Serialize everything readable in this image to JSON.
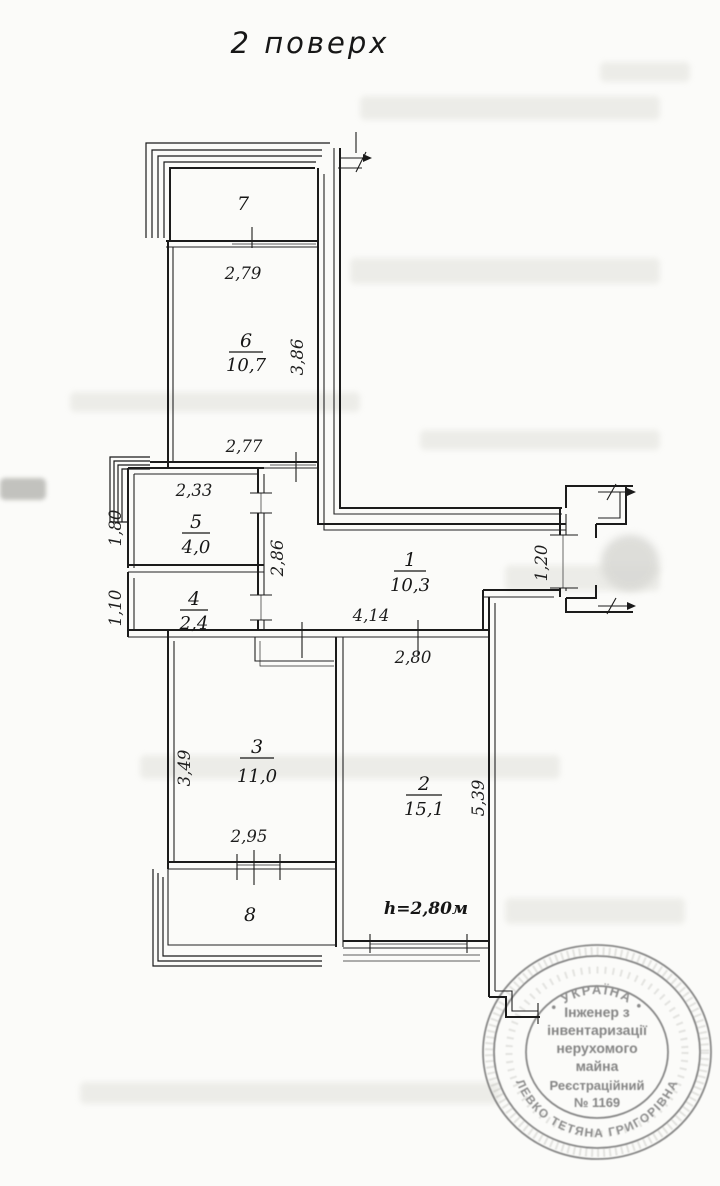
{
  "title": "2 поверх",
  "rooms": {
    "r1": {
      "number": "1",
      "area": "10,3"
    },
    "r2": {
      "number": "2",
      "area": "15,1"
    },
    "r3": {
      "number": "3",
      "area": "11,0"
    },
    "r4": {
      "number": "4",
      "area": "2,4"
    },
    "r5": {
      "number": "5",
      "area": "4,0"
    },
    "r6": {
      "number": "6",
      "area": "10,7"
    },
    "r7": {
      "number": "7"
    },
    "r8": {
      "number": "8"
    }
  },
  "dimensions": {
    "balcony7_width": "2,79",
    "room6_depth": "3,86",
    "room6_width": "2,77",
    "room5_width": "2,33",
    "room5_depth": "1,80",
    "hall_depth": "2,86",
    "room4_depth": "1,10",
    "hall_length": "4,14",
    "room2_width": "2,80",
    "entry_width": "1,20",
    "room3_depth": "3,49",
    "room3_width": "2,95",
    "room2_depth": "5,39"
  },
  "ceiling_height": "h=2,80м",
  "stamp": {
    "arc_top": "• УКРАЇНА •",
    "line1": "Інженер з",
    "line2": "інвентаризації",
    "line3": "нерухомого",
    "line4": "майна",
    "line5": "Реєстраційний",
    "line6": "№ 1169",
    "arc_bottom": "ЛЕВКО ТЕТЯНА ГРИГОРІВНА"
  },
  "colors": {
    "ink": "#1b1b1b",
    "stamp_ink": "#6e6e6e",
    "paper": "#fbfbf9"
  }
}
